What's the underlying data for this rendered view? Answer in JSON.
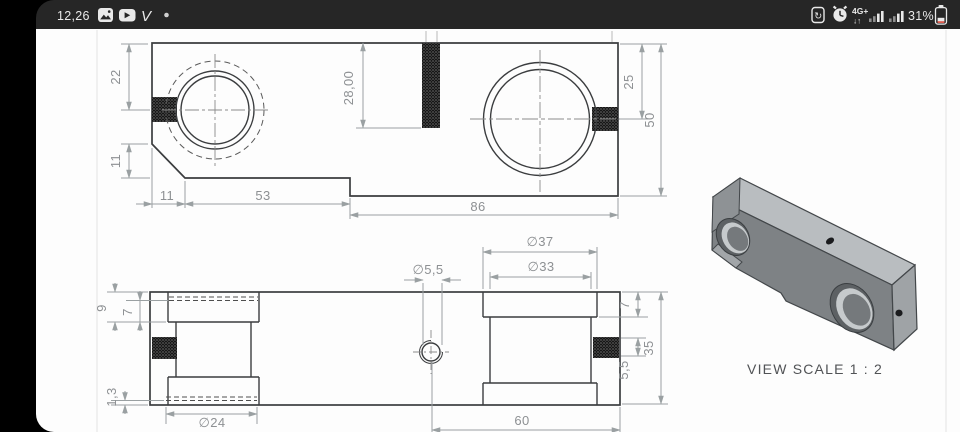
{
  "status_bar": {
    "time": "12,26",
    "notification_icons": [
      {
        "name": "gallery-icon"
      },
      {
        "name": "youtube-icon"
      },
      {
        "name": "vimeo-icon"
      },
      {
        "name": "more-notifications-dot"
      }
    ],
    "vimeo_glyph": "V",
    "network_type": "4G+",
    "network_arrows": "↓↑",
    "battery_percent": "31%"
  },
  "drawing": {
    "top_view": {
      "dims": {
        "height_left": "22",
        "chamfer_height": "11",
        "chamfer_width": "11",
        "length_left": "53",
        "length_right": "86",
        "thread_depth": "28,00",
        "hole_offset_right": "25",
        "width_total": "50"
      }
    },
    "front_view": {
      "dims": {
        "cbore_left_outer": "9",
        "cbore_left_inner": "7",
        "step_left": "1,3",
        "dia_bore": "∅24",
        "dia_small": "∅5,5",
        "dia_cbore_outer": "∅37",
        "dia_cbore_inner": "∅33",
        "cbore_right_depth": "7",
        "thread_offset": "5,5",
        "height_total": "35",
        "hole_to_end": "60"
      }
    },
    "iso_view": {
      "caption": "VIEW SCALE 1 : 2"
    }
  }
}
